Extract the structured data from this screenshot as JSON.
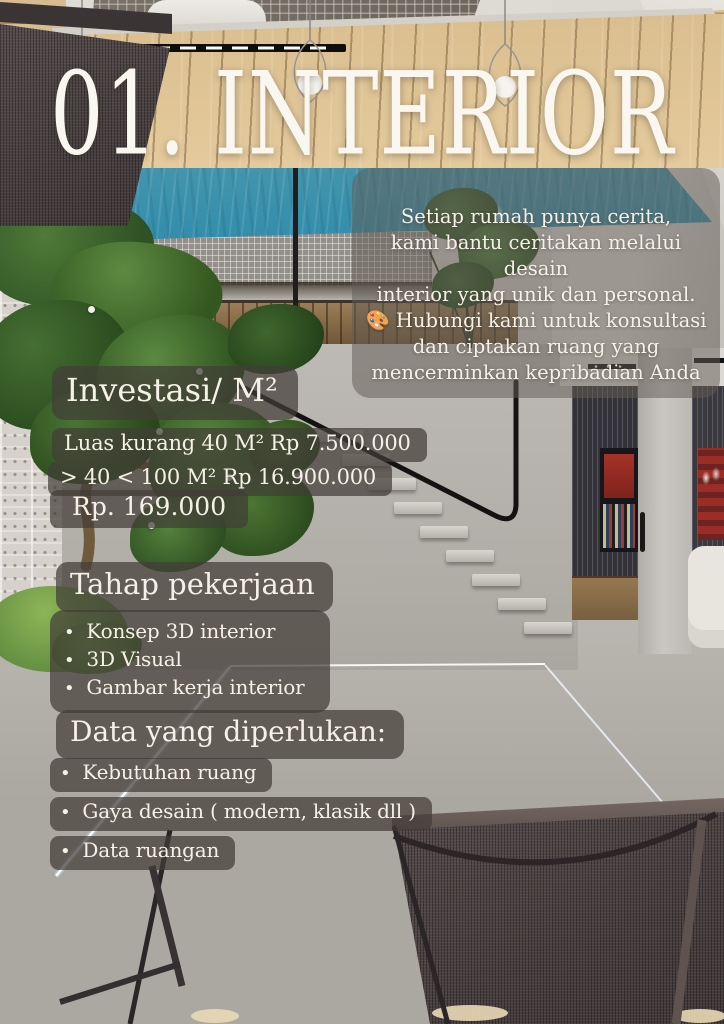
{
  "poster": {
    "title": "01. INTERIOR",
    "intro_text": "Setiap rumah punya cerita,\nkami bantu ceritakan melalui desain\ninterior yang unik dan personal.\n🎨 Hubungi kami untuk konsultasi\ndan ciptakan ruang yang\nmencerminkan kepribadian Anda",
    "investment": {
      "heading": "Investasi/ M²",
      "rows": [
        "Luas kurang 40 M² Rp 7.500.000",
        "> 40 < 100  M² Rp 16.900.000"
      ],
      "highlight": "Rp. 169.000"
    },
    "work_stages": {
      "heading": "Tahap pekerjaan",
      "items": [
        "Konsep 3D interior",
        "3D Visual",
        "Gambar kerja interior"
      ]
    },
    "required_data": {
      "heading": "Data yang diperlukan:",
      "items": [
        "Kebutuhan ruang",
        "Gaya desain ( modern, klasik dll )",
        "Data ruangan"
      ]
    },
    "colors": {
      "overlay_pill": "#423d37",
      "text": "#f6f1e7",
      "pool_water": "#3f93ad",
      "deck_wood": "#dcc194"
    }
  }
}
